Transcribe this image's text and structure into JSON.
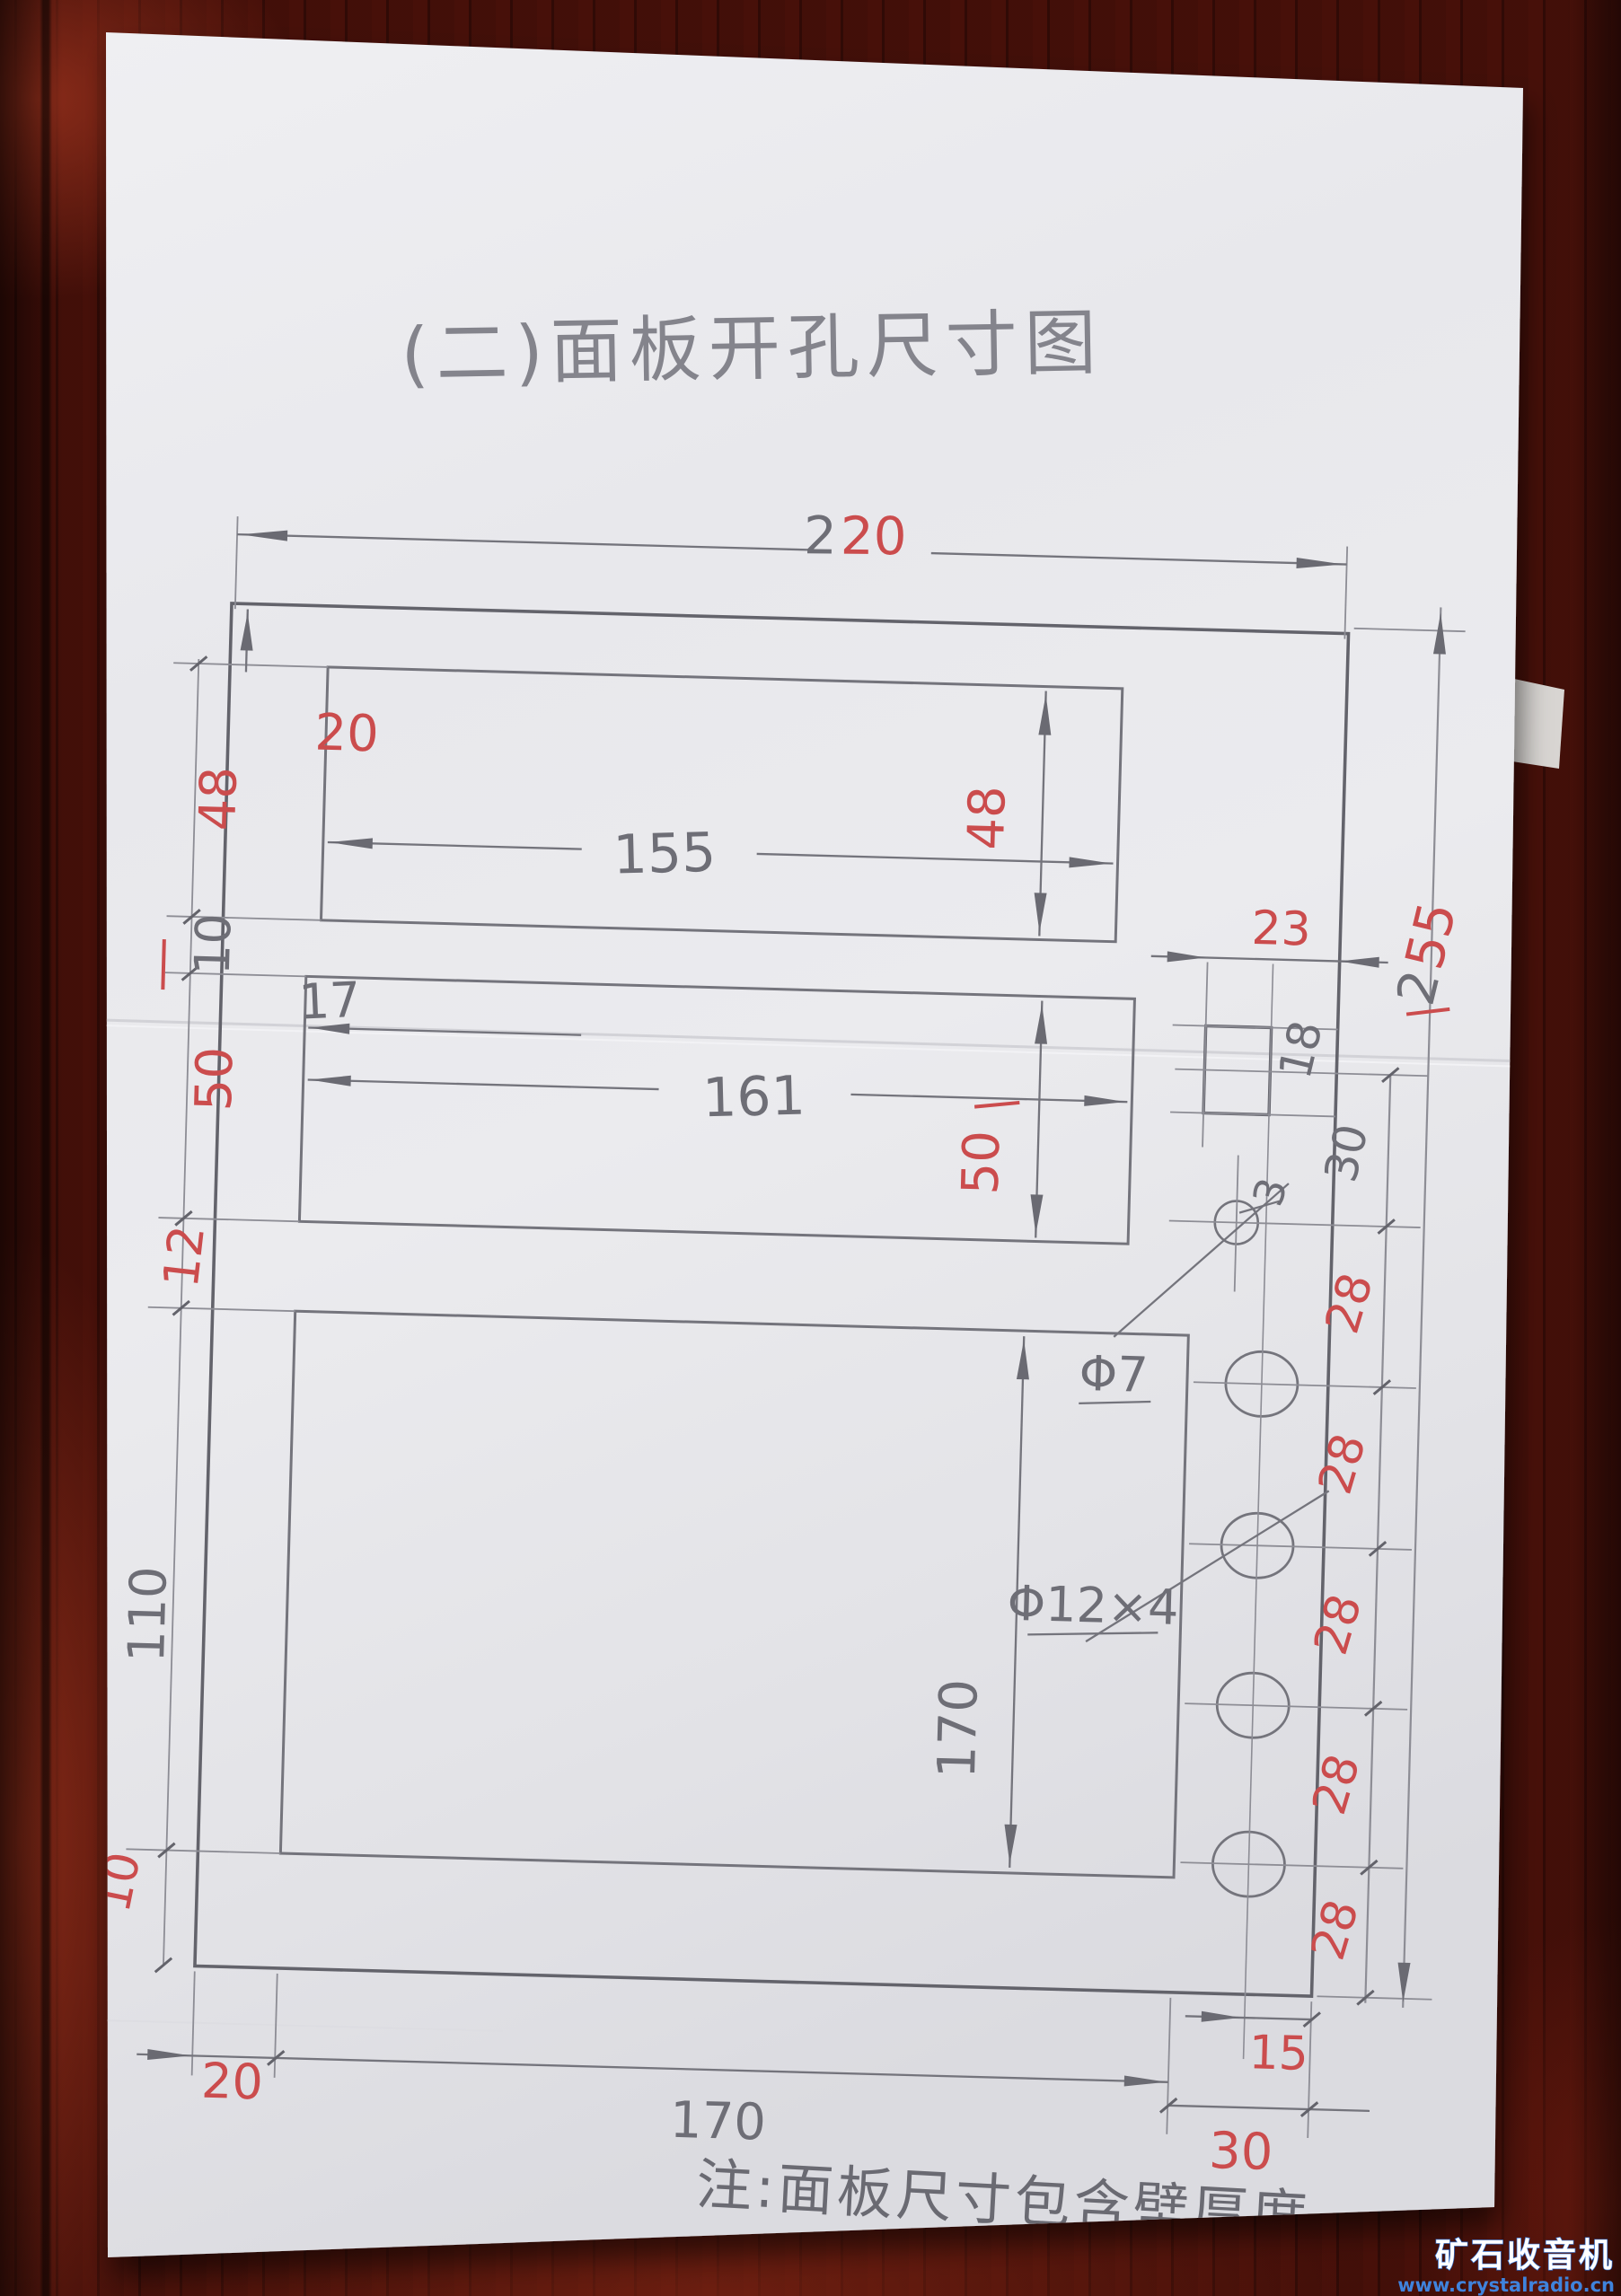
{
  "photo": {
    "title": "(二)面板开孔尺寸图",
    "note": "注:面板尺寸包含壁厚度",
    "watermark": {
      "name": "矿石收音机",
      "url": "www.crystalradio.cn"
    },
    "colors": {
      "pencil": "#6e6e76",
      "red": "#cb4c4d",
      "paper": "#e9e9ec",
      "wood": "#3c0d08",
      "watermark_blue": "#2f6fd0"
    },
    "dims": {
      "overall_width": {
        "prefix": "2",
        "suffix": "20"
      },
      "overall_height": {
        "prefix": "2",
        "suffix": "55"
      },
      "top_margin": "20",
      "slot1": {
        "width": "155",
        "height": "48"
      },
      "gap_slot1_slot2": "10",
      "slot2_offset": "17",
      "slot2": {
        "width": "161",
        "height": "50"
      },
      "gap_slot2_panel": "12",
      "panel_left_height": "110",
      "panel_inner_height": "170",
      "bottom_left_gap": "10",
      "small_hole": {
        "label": "Φ7"
      },
      "large_holes": {
        "label": "Φ12×4"
      },
      "hole_spacing": [
        "28",
        "28",
        "28",
        "28",
        "28"
      ],
      "small_rect": {
        "width": "23",
        "height": "18",
        "offset": "30",
        "edge_gap": "3"
      },
      "center_to_edge": "15",
      "bottom_margin_left": "20",
      "bottom_width": "170",
      "bottom_margin_right": "30"
    }
  }
}
